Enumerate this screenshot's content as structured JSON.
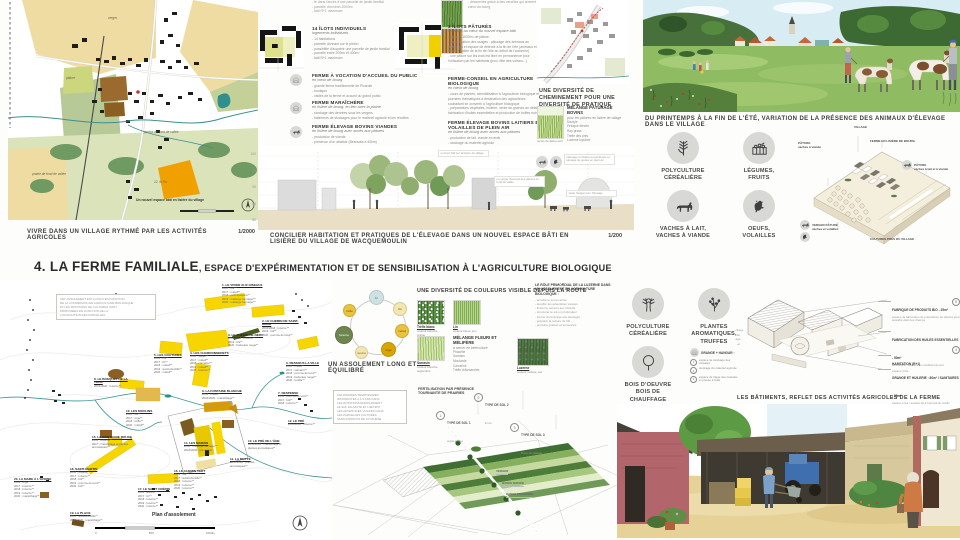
{
  "title": {
    "num": "4.",
    "main": " LA FERME FAMILIALE",
    "rest": ", ESPACE D'EXPÉRIMENTATION ET DE SENSIBILISATION À L'AGRICULTURE BIOLOGIQUE"
  },
  "colors": {
    "accent_yellow": "#f6d500",
    "map_beige": "#eedca2",
    "water_teal": "#3a9191",
    "orange_parcel": "#f0a100",
    "icon_circle": "#d8d8d4"
  },
  "village_map": {
    "caption": "VIVRE DANS UN VILLAGE RYTHMÉ PAR LES ACTIVITÉS AGRICOLES",
    "scale": "1/2000",
    "scale_labels": [
      "0",
      "50",
      "100m"
    ],
    "labels": [
      {
        "x": 100,
        "y": 16,
        "t": "verger"
      },
      {
        "x": 58,
        "y": 76,
        "t": "pâture"
      },
      {
        "x": 136,
        "y": 130,
        "t": "jardins de fond de vallée"
      },
      {
        "x": 24,
        "y": 172,
        "t": "prairie de fond de vallée"
      },
      {
        "x": 128,
        "y": 198,
        "t": "Un nouvel espace bâti en lisière du village",
        "dark": true
      },
      {
        "x": 146,
        "y": 180,
        "t": "12, le Pa"
      }
    ]
  },
  "programme1": {
    "top_partial": [
      "- te dans l'accès d'une parcelle de jardin familial",
      "- parcelle d'environ 2000m²",
      "- bâti R+1 maximum"
    ],
    "blocks": [
      {
        "title": "14 ÎLOTS INDIVIDUELS",
        "subtitle": "logements individuels",
        "bullets": [
          "- 14 habitations",
          "- parcelle donnant sur le piéton",
          "- possibilité d'acquérir une parcelle de jardin familial",
          "- parcelle entre 200m² et 400m²",
          "- bâti R+1 maximum"
        ]
      },
      {
        "title": "FERME À VOCATION D'ACCUEIL DU PUBLIC",
        "subtitle": "en cœur de bourg",
        "bullets": [
          "- grande ferme traditionnelle de Picardie",
          "- boutique",
          "- visites de la ferme et accueil du grand public"
        ]
      },
      {
        "title": "FERME MARAÎCHÈRE",
        "subtitle": "en lisière de bourg, en lien avec la plaine",
        "bullets": [
          "- stockage des denrées sous les vergers",
          "- bâtiments de stockages pour le matériel agricole et les récoltes"
        ]
      },
      {
        "title": "FERME ÉLEVAGE BOVINS VIANDES",
        "subtitle": "en lisière de bourg avec accès aux pâtures",
        "bullets": [
          "- production de viande",
          "- présence d'un abattoir (Beauvais à 40km)"
        ]
      }
    ]
  },
  "programme2": {
    "top_partial": [
      "- desservies grâce à des venelles qui arrivent au cœur du bourg"
    ],
    "blocks": [
      {
        "title": "3 ÎLOTS PÂTURÉS",
        "subtitle": "localisés au cœur du nouvel espace bâti",
        "bullets": [
          "- environ 1000m² de pâture",
          "- multiplication des usages : pâturage des animaux au printemps et espace de détente à la fin de l'été (animaux en fond de vallée de la fin de l'été au début de l'automne)",
          "- une pâture sur les trois est libre en permanence pour l'utilisation par les habitants (jeux, fête des voisins...)"
        ]
      },
      {
        "title": "FERME-CONSEIL EN AGRICULTURE BIOLOGIQUE",
        "subtitle": "en cœur de bourg",
        "bullets": [
          "- cours de plantes, sensibilisation à l'agriculture biologique et journées thématiques à destination des agriculteurs souhaitant se convertir à l'agriculture biologique",
          "- préparations végétales, huilerie, vente de graines au détail, fabrication d'huiles essentielles et production de truffes noires"
        ]
      },
      {
        "title": "FERME ÉLEVAGE BOVINS LAITIERS ET VOLAILLES DE PLEIN AIR",
        "subtitle": "en lisière de bourg avec accès aux pâtures",
        "bullets": [
          "- production de lait, viande et œufs",
          "- stockage du matériel agricole"
        ]
      }
    ]
  },
  "cheminement": {
    "caption": "UNE DIVERSITÉ DE CHEMINEMENT POUR UNE DIVERSITÉ DE PRATIQUE"
  },
  "melange_paturage": {
    "title": "MÉLANGE PÂTURAGE BOVINS",
    "subtitle": "pour les pâtures en lisière de village",
    "species": [
      "Dactyle",
      "Fétuque élevée",
      "Ray-grass",
      "Trèfle des prés",
      "Luzerne lupuline"
    ],
    "photo_caption": "semis de début avril"
  },
  "section": {
    "caption": "CONCILIER HABITATION ET PRATIQUES DE L'ÉLEVAGE DANS UN NOUVEL ESPACE BÂTI EN LISIÈRE DU VILLAGE DE WACQUEMOULIN",
    "scale": "1/200",
    "elevations": [
      "100",
      "95",
      "90",
      "85",
      "80"
    ],
    "notes": [
      {
        "x": 180,
        "y": 4,
        "t": "un front bâti sur la lisière du village"
      },
      {
        "x": 236,
        "y": 30,
        "t": "un verger d'accueil des pâtures en fond de vallée"
      },
      {
        "x": 306,
        "y": 8,
        "t": "pâturage en lisière au printemps et élevage de poules en plein air"
      },
      {
        "x": 308,
        "y": 44,
        "t": "vaste hangar pour l'élevage"
      }
    ]
  },
  "pasture": {
    "caption": "DU PRINTEMPS À LA FIN DE L'ÉTÉ, VARIATION DE LA PRÉSENCE DES ANIMAUX D'ÉLEVAGE DANS LE VILLAGE"
  },
  "activity_icons_top": [
    {
      "label": [
        "POLYCULTURE",
        "CÉRÉALIÈRE"
      ]
    },
    {
      "label": [
        "LÉGUMES,",
        "FRUITS"
      ]
    },
    {
      "label": [
        "VACHES À LAIT,",
        "VACHES À VIANDE"
      ]
    },
    {
      "label": [
        "OEUFS,",
        "VOLAILLES"
      ]
    }
  ],
  "axon_village": {
    "labels": [
      {
        "x": 56,
        "y": 0,
        "t": "VILLAGE"
      },
      {
        "x": 72,
        "y": 14,
        "t": "FERME EN LISIÈRE DE BOURG"
      },
      {
        "x": 116,
        "y": 38,
        "t": "PÂTURE\nvaches à lait et à viande"
      },
      {
        "x": 0,
        "y": 16,
        "t": "PÂTURE\nvaches à viande"
      },
      {
        "x": 14,
        "y": 98,
        "t": "VERGER PÂTURÉ\nvaches et volailles"
      },
      {
        "x": 72,
        "y": 112,
        "t": "CULTURES PRÈS DU VILLAGE"
      }
    ]
  },
  "assolement_map": {
    "caption": "Plan d'assolement",
    "scale_labels": [
      "0",
      "500",
      "1000m"
    ],
    "note": [
      "CET ASSOLEMENT EST CONÇU EN FONCTION",
      "DE LA CONVERSION EN AGRICULTURE BIOLOGIQUE",
      "ET LES ROTATIONS DE CULTURES SONT",
      "PROPOSÉES EN FONCTION DE LA",
      "LOCALISATION DES PARCELLES"
    ],
    "parcels": [
      {
        "x": 222,
        "y": 4,
        "name": "1. LE VIVIER AUX OISEAUX",
        "lines": [
          "2016 : blé**",
          "2017 : méteil**",
          "2018 : petit épeautre**",
          "2019 : mélange fourrager**",
          "2020 : mélange fourrager**"
        ]
      },
      {
        "x": 262,
        "y": 40,
        "name": "2. LE CHEMIN DE SAINT-MAUR",
        "lines": [
          "2016/2018 : luzerne**",
          "2019 : blé**",
          "2020 : pomme de terre**"
        ]
      },
      {
        "x": 228,
        "y": 54,
        "name": "3. LE CHEMIN DE NÉRY",
        "lines": [
          "2016/2018 : luzerne**",
          "2019 : blé**",
          "2020 : betterave rouge**"
        ]
      },
      {
        "x": 190,
        "y": 72,
        "name": "4. LES CHARDONNERETS",
        "lines": [
          "2016 : seigle**",
          "2017 : méteil**",
          "2018 : cameline**",
          "2019 : méteil**",
          "2020 : luzerne**"
        ]
      },
      {
        "x": 154,
        "y": 74,
        "name": "5. LES COUTURES",
        "lines": [
          "2016 : blé**",
          "2017 : lin**",
          "2018 : méteil**",
          "2019 : avoine/lentille**",
          "2020 : méteil**"
        ]
      },
      {
        "x": 286,
        "y": 82,
        "name": "6. DESSOUS LA VILLE",
        "lines": [
          "2016 : méteil**",
          "2017 : sarrasin**",
          "2018 : pomme de terre**",
          "2019 : betterave rouge**",
          "2020 : lentille**"
        ]
      },
      {
        "x": 278,
        "y": 112,
        "name": "7. DESPENSE",
        "lines": [
          "2016 : pomme de terre**",
          "2017 : blé**",
          "2018 : luzerne**"
        ]
      },
      {
        "x": 94,
        "y": 98,
        "name": "8. LE BOSQUET DE LA TOUR",
        "lines": [
          "2016/2020 : luzerne**"
        ]
      },
      {
        "x": 202,
        "y": 110,
        "name": "9. LA FONTAINE BLANCHE",
        "lines": [
          "2016 : méteil**",
          "2016/2020 : maraîchage**"
        ]
      },
      {
        "x": 126,
        "y": 130,
        "name": "10. LES MOULINS",
        "lines": [
          "2016 : blé**",
          "2017 : orge**",
          "2018 : trèfle**",
          "2020 : méteil**"
        ]
      },
      {
        "x": 230,
        "y": 178,
        "name": "11. LA MOTTE",
        "lines": [
          "2016/2020 : plantes aromatiques**"
        ]
      },
      {
        "x": 288,
        "y": 140,
        "name": "12. LE PRÉ",
        "lines": [
          "2016/2020 : luzerne**"
        ]
      },
      {
        "x": 248,
        "y": 160,
        "name": "13. LE PRÉ DE L'ÂNE",
        "lines": [
          "2016/2020 : maraîchage et plantes aromatiques**"
        ]
      },
      {
        "x": 184,
        "y": 162,
        "name": "14. LES MARAIS",
        "lines": [
          "2016 : mélange fourrager**",
          "2016/2020 : pré verger"
        ]
      },
      {
        "x": 92,
        "y": 156,
        "name": "15. LA MONTAGNE ROUGE",
        "lines": [
          "2016 : luzerne**",
          "2017 : maraîchage et plantes aromatiques**"
        ]
      },
      {
        "x": 174,
        "y": 190,
        "name": "16. LE CHEMIN VERT",
        "lines": [
          "2016 : blé**",
          "2017 : avoine/lentille**",
          "2018 : luzerne**",
          "2019 : luzerne**",
          "2020 : luzerne**"
        ]
      },
      {
        "x": 138,
        "y": 208,
        "name": "17. LE SAINT CRÉPIN",
        "lines": [
          "2016 : avoine**",
          "2017 : lin**",
          "2018 : luzerne**",
          "2019 : luzerne**",
          "2020 : luzerne**"
        ]
      },
      {
        "x": 70,
        "y": 188,
        "name": "18. SAINT-MARTIN",
        "lines": [
          "2016 : luzerne**",
          "2017 : luzerne**",
          "2018 : blé**",
          "2019 : pomme de terre**",
          "2020 : blé**"
        ]
      },
      {
        "x": 70,
        "y": 232,
        "name": "19. LA PLACE",
        "lines": [
          "2016 : avoine/lentille**",
          "2016/2020 : maraîchage**"
        ]
      },
      {
        "x": 14,
        "y": 198,
        "name": "20. LA MARE À L'AVOINE",
        "lines": [
          "2016 : orge**",
          "2017 : luzerne**",
          "2018 : luzerne**",
          "2019 : luzerne**",
          "2020 : maraîchage**"
        ]
      }
    ]
  },
  "rotation": {
    "caption": "UN ASSOLEMENT LONG ET ÉQUILIBRÉ",
    "crops": [
      {
        "x": 36,
        "y": 0,
        "size": 13,
        "color": "#cfe2e3",
        "tc": "#4a6a6a",
        "label": "lin"
      },
      {
        "x": 60,
        "y": 12,
        "size": 12,
        "color": "#f3e6b0",
        "tc": "#7a6a30",
        "label": "blé"
      },
      {
        "x": 62,
        "y": 34,
        "size": 12,
        "color": "#eac33c",
        "tc": "#6b520e",
        "label": "méteil"
      },
      {
        "x": 48,
        "y": 52,
        "size": 13,
        "color": "#d9a500",
        "tc": "#5d4705",
        "label": "orge"
      },
      {
        "x": 22,
        "y": 56,
        "size": 11,
        "color": "#f3e6b0",
        "tc": "#7a6a30",
        "label": "avoine"
      },
      {
        "x": 2,
        "y": 36,
        "size": 16,
        "color": "#6f8550",
        "tc": "#ffffff",
        "label": "luzerne"
      },
      {
        "x": 10,
        "y": 14,
        "size": 11,
        "color": "#eac33c",
        "tc": "#6b520e",
        "label": "trèfle"
      }
    ]
  },
  "couleurs": {
    "caption": "UNE DIVERSITÉ DE COULEURS VISIBLE DEPUIS LA ROUTE",
    "photos": [
      {
        "name": "Trèfle blanc",
        "desc": "couleur blanche, prairie"
      },
      {
        "name": "Lin",
        "desc": "couleur bleue, juin"
      },
      {
        "name": "Sarrasin",
        "desc": "couleur blanche, septembre"
      },
      {
        "name": "Luzerne",
        "desc": "couleur violette, été"
      }
    ],
    "melange": {
      "title": "MÉLANGE FLEURI ET MÉLIFÈRE",
      "subtitle": "à semer en interculture",
      "species": [
        "Phacélie",
        "Sarrasin",
        "Moutarde",
        "Cameline",
        "Trèfle d'Alexandrie"
      ]
    }
  },
  "luzerne_role": {
    "title": "LE RÔLE PRIMORDIAL DE LA LUZERNE DANS UN ASSOLEMENT EN AGRICULTURE BIOLOGIQUE :",
    "bullets": [
      "- enrichir le sol en azote",
      "- étouffer les adventices vivaces",
      "- limiter le recours aux intrants",
      "- structurer le sol en profondeur",
      "- fournir du fourrage aux élevages",
      "- préparer la culture du blé",
      "- produire graines et semences"
    ]
  },
  "fertilisation": {
    "box": [
      "LES PRAIRIES TEMPORAIRES",
      "INTRODUITES 2 À 5 ANS DANS",
      "LES ROTATIONS ENRICHISSENT",
      "LE SOL EN AZOTE ET LIMITENT",
      "LES ADVENTICES VIVACES DANS",
      "LES PARCELLES CULTIVÉES",
      "SANS INTRANTS DE SYNTHÈSE"
    ],
    "title": "FERTILISATION PAR PRÉSENCE\nTOURNANTE DE PRAIRIES",
    "soils": [
      {
        "x": 108,
        "y": 26,
        "num": "1",
        "t": "TYPE DE SOL 1",
        "d": "argile à silex"
      },
      {
        "x": 146,
        "y": 8,
        "num": "2",
        "t": "TYPE DE SOL 2",
        "d": "limon"
      },
      {
        "x": 182,
        "y": 38,
        "num": "3",
        "t": "TYPE DE SOL 3",
        "d": "limon de plateau"
      }
    ],
    "field_labels": [
      {
        "x": 168,
        "y": 84,
        "t": "VERGER"
      },
      {
        "x": 174,
        "y": 96,
        "t": "BANDE BOISÉE"
      },
      {
        "x": 178,
        "y": 107,
        "t": "BANDE ENHERBÉE"
      }
    ]
  },
  "activity_icons_bottom": [
    {
      "label": [
        "POLYCULTURE",
        "CÉRÉALIÈRE"
      ]
    },
    {
      "label": [
        "PLANTES",
        "AROMATIQUES,",
        "TRUFFES"
      ]
    },
    {
      "label": [
        "BOIS D'OEUVRE",
        "BOIS DE CHAUFFAGE"
      ]
    }
  ],
  "grange_legend": {
    "title": "GRANGE + HANGAR :",
    "items": [
      {
        "num": "1",
        "t": "espace de stockage des céréales"
      },
      {
        "num": "2",
        "t": "stockage du matériel agricole"
      },
      {
        "num": "3",
        "t": "espace de triage des céréales et presse à huile"
      }
    ]
  },
  "farm_axon": {
    "caption": "LES BÂTIMENTS, REFLET DES ACTIVITÉS AGRICOLES DE LA FERME",
    "left_partials": [
      "..ckage",
      "..du",
      "..age",
      "..et"
    ],
    "labels": [
      {
        "y": 10,
        "t": "FABRIQUE DE PRODUITS BIO - 25m²",
        "d": "espace de fabrication de préparation de plantes pour épandre dans les champs",
        "num": "5"
      },
      {
        "y": 40,
        "t": "FABRICATION DES HUILES ESSENTIELLES - 50m²",
        "d": "laboratoire, distillerie et conditionnement",
        "num": "4"
      },
      {
        "y": 64,
        "t": "HABITATION (R+1)",
        "d": "espace privé"
      },
      {
        "y": 78,
        "t": "GRANGE ET HUILERIE : 80m² / SANITAIRES - 30m²",
        "d": "espace privé / espace lié à l'accueil du public"
      }
    ]
  }
}
